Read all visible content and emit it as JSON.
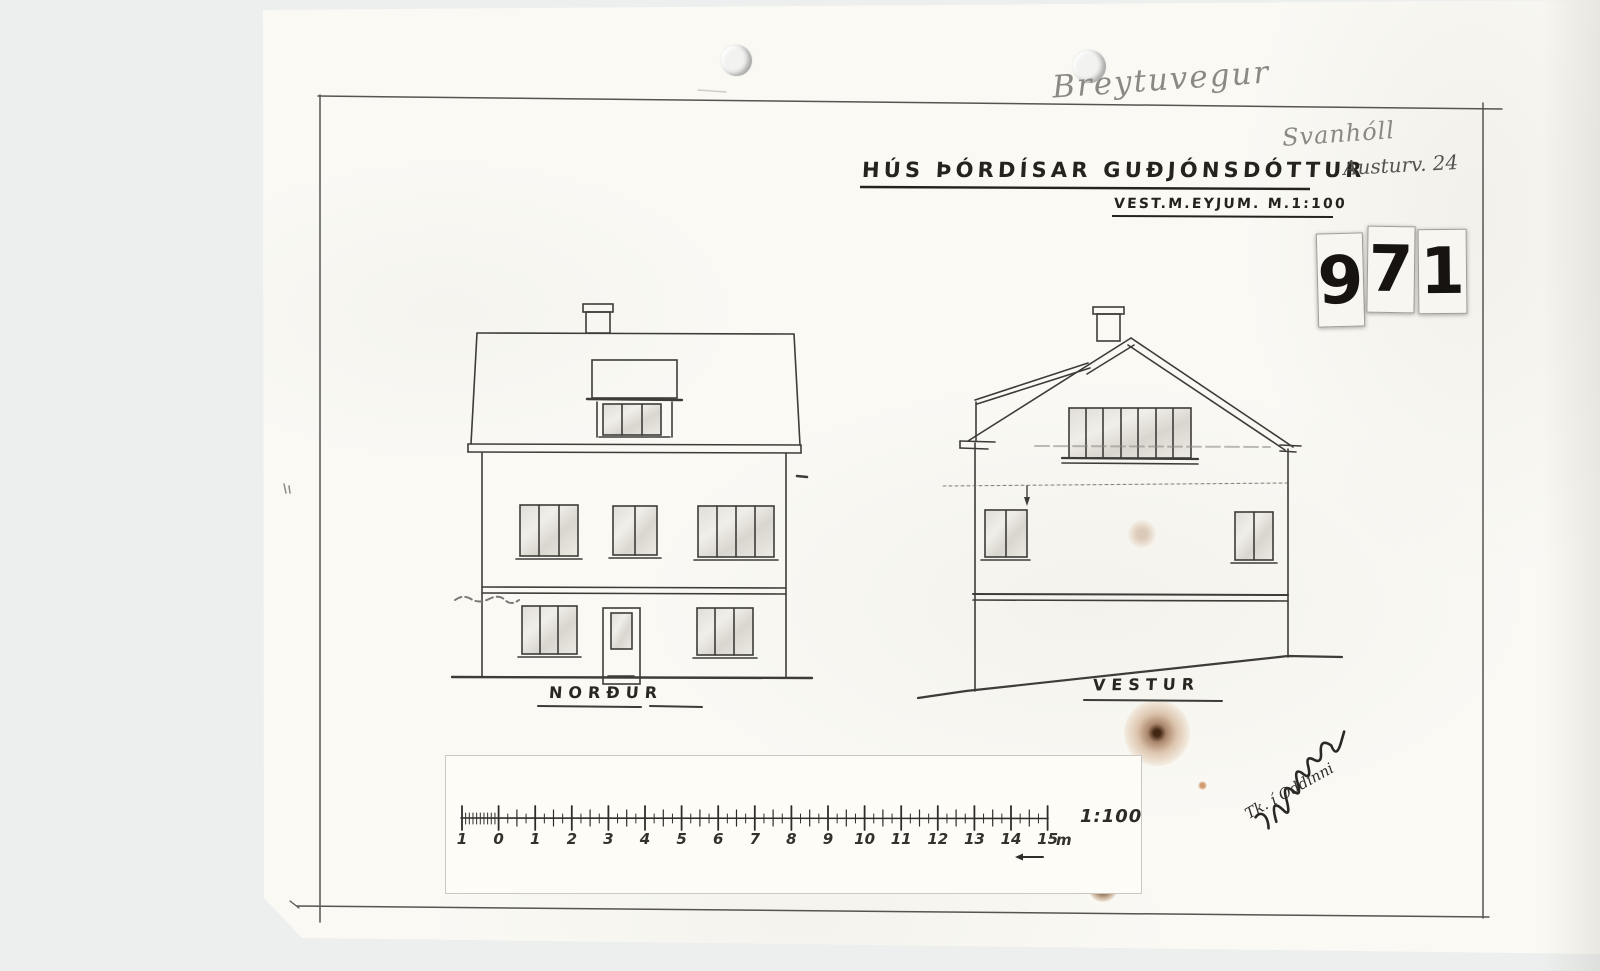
{
  "document": {
    "kind": "scanned architectural drawing",
    "title": "HÚS ÞÓRDÍSAR GUÐJÓNSDÓTTUR",
    "subtitle": "VEST.M.EYJUM. M.1:100",
    "sheet_number": "971",
    "sheet_digits": [
      "9",
      "7",
      "1"
    ],
    "labels": {
      "nordur": "NORÐUR",
      "vestur": "VESTUR"
    },
    "handwriting": {
      "street_pencil": "Breytuvegur",
      "house_name_pencil": "Svanhóll",
      "address_pencil": "Austurv. 24",
      "note_pencil": "Tk. í Oddinni"
    },
    "scale_bar": {
      "labels": [
        "1",
        "0",
        "1",
        "2",
        "3",
        "4",
        "5",
        "6",
        "7",
        "8",
        "9",
        "10",
        "11",
        "12",
        "13",
        "14",
        "15"
      ],
      "unit": "m",
      "ratio": "1:100"
    }
  },
  "colors": {
    "paper": "#faf9f4",
    "ink": "#3e3c38",
    "pencil": "#8b8984",
    "stain": "#7a4018"
  }
}
